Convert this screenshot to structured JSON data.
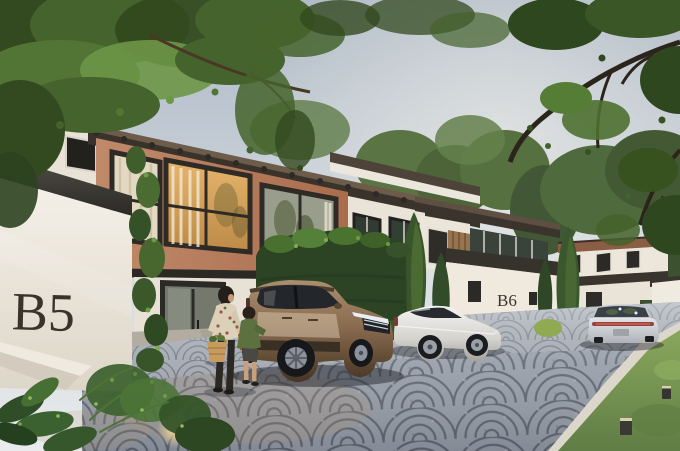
{
  "scene": {
    "title": "Townhouse development exterior rendering",
    "setting": "Row of modern two-storey townhouses along a curved cobblestone street on a hazy sunny day",
    "unit_signs": {
      "left_wall": "B5",
      "middle_wall": "B6"
    },
    "vehicles": [
      {
        "name": "bronze SUV",
        "color": "#8a6c50",
        "position": "parked at unit B5 driveway, front three-quarter view"
      },
      {
        "name": "white luxury sedan",
        "color": "#eceae6",
        "position": "parked in front of unit B6, side view"
      },
      {
        "name": "silver sedan",
        "color": "#c6c9cd",
        "position": "on street at right, rear view"
      }
    ],
    "people": [
      {
        "name": "woman",
        "detail": "floral blouse, dark trousers, standing by SUV with straw basket"
      },
      {
        "name": "child",
        "detail": "green jacket, standing beside woman"
      }
    ],
    "landscape": [
      "overhanging tree canopy",
      "tall cypress trees",
      "clipped hedge",
      "fern planter with accent light",
      "lawn with bollard lights"
    ],
    "materials": {
      "street": "fan-pattern cobblestone",
      "walls": "white stucco with charcoal coping",
      "upper_facade": "terracotta plaster with amber glazing",
      "roof": "dark clay tile"
    },
    "palette": {
      "sky": "#c3ccd4",
      "stucco": "#efebe2",
      "terracotta": "#bd8767",
      "roof": "#36322c",
      "foliage": "#4a6a33",
      "cobblestone": "#9aa0aa",
      "grass": "#7d9b55",
      "sign_text": "#3a332a"
    }
  }
}
